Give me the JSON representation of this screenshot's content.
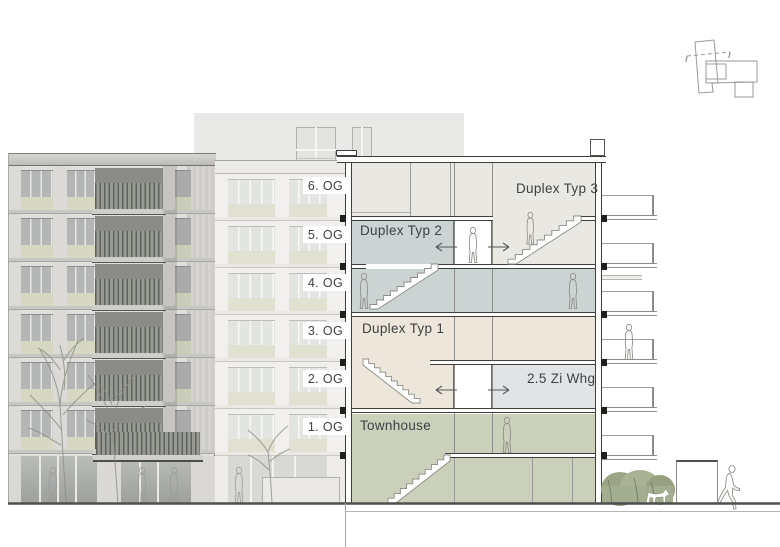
{
  "floor_labels": [
    "6. OG",
    "5. OG",
    "4. OG",
    "3. OG",
    "2. OG",
    "1. OG"
  ],
  "units": {
    "duplex_typ_3": "Duplex Typ 3",
    "duplex_typ_2": "Duplex Typ 2",
    "duplex_typ_1": "Duplex Typ 1",
    "zi_whg": "2.5 Zi Whg",
    "townhouse": "Townhouse"
  },
  "colors": {
    "duplex_typ_3_fill": "#e9e8e3",
    "duplex_typ_2_fill": "#ccd3d3",
    "duplex_typ_1_fill": "#ece7da",
    "zi_whg_fill": "#e2e3e5",
    "townhouse_fill": "#cbd0ba",
    "lobby_fill": "#ffffff",
    "facade_spandrel_left": "#d6d8c3",
    "facade_spandrel_middle": "#e0e1d1",
    "section_outline": "#3f3f3d",
    "label_text": "#3d4243",
    "ground_line": "#4f4f4c",
    "hedge_green": "#a3ad90"
  }
}
